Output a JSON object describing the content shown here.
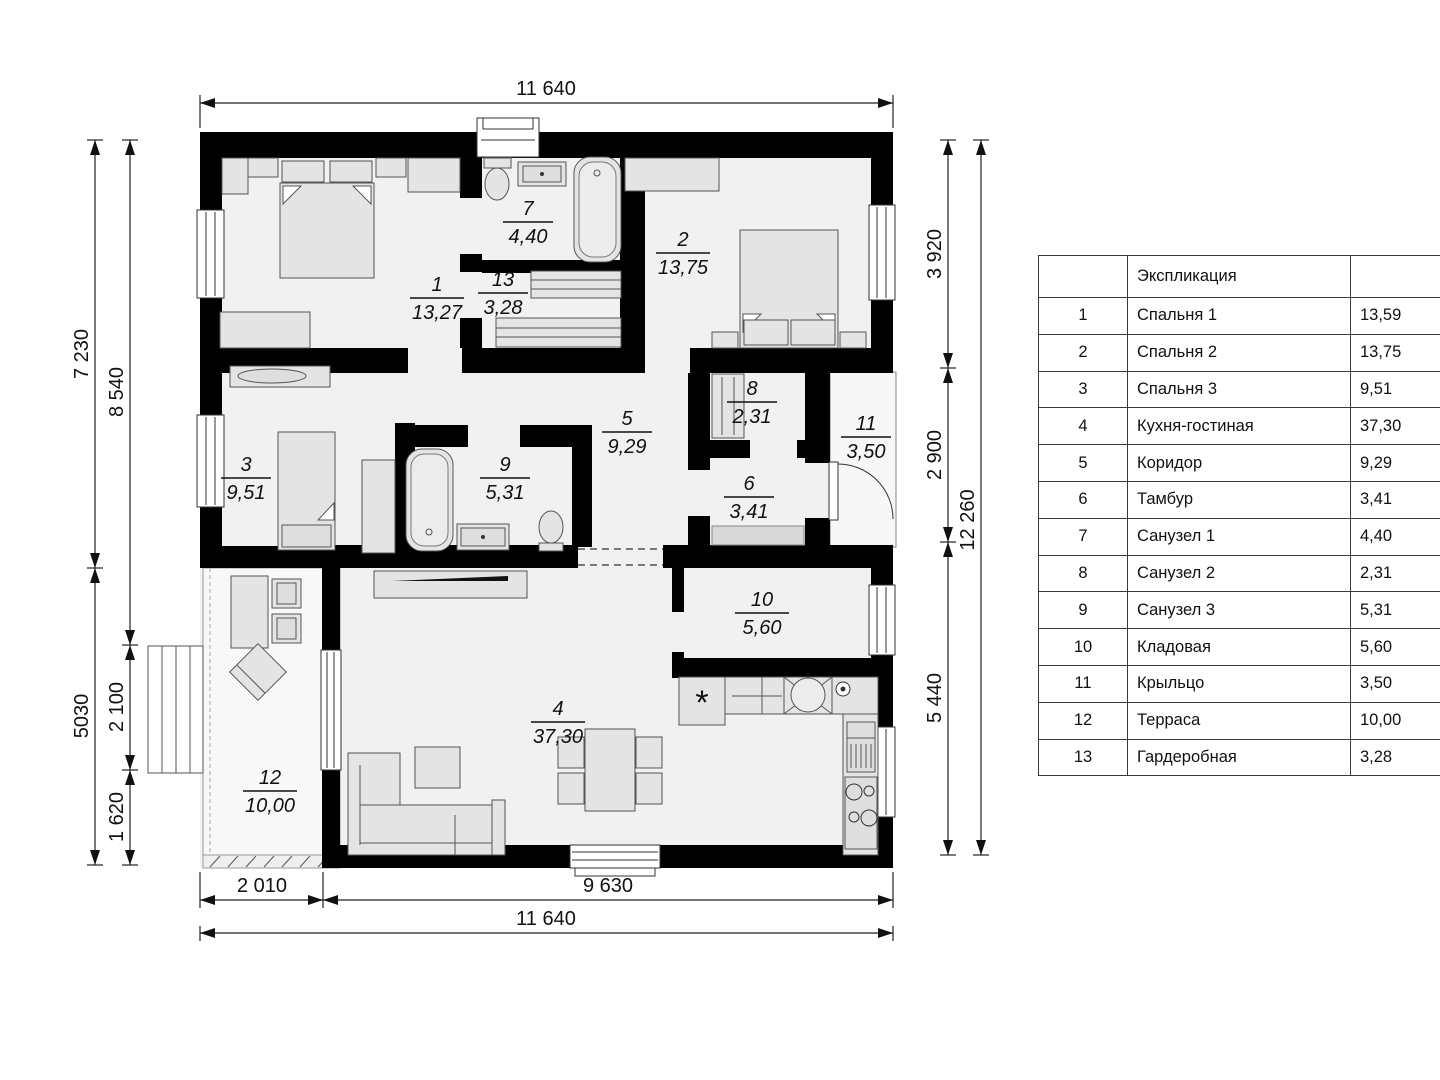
{
  "plan": {
    "rooms": [
      {
        "num": "1",
        "area": "13,27"
      },
      {
        "num": "2",
        "area": "13,75"
      },
      {
        "num": "3",
        "area": "9,51"
      },
      {
        "num": "4",
        "area": "37,30"
      },
      {
        "num": "5",
        "area": "9,29"
      },
      {
        "num": "6",
        "area": "3,41"
      },
      {
        "num": "7",
        "area": "4,40"
      },
      {
        "num": "8",
        "area": "2,31"
      },
      {
        "num": "9",
        "area": "5,31"
      },
      {
        "num": "10",
        "area": "5,60"
      },
      {
        "num": "11",
        "area": "3,50"
      },
      {
        "num": "12",
        "area": "10,00"
      },
      {
        "num": "13",
        "area": "3,28"
      }
    ],
    "dims": {
      "top": "11 640",
      "bottom_left": "2 010",
      "bottom_right": "9 630",
      "bottom_total": "11 640",
      "left_upper": "7 230",
      "left_lower": "5030",
      "left_inner_upper": "8 540",
      "left_inner_mid": "2 100",
      "left_inner_low": "1 620",
      "right_top": "3 920",
      "right_mid": "2 900",
      "right_low": "5 440",
      "right_total": "12 260"
    },
    "symbols": {
      "dishwasher": "*"
    }
  },
  "table": {
    "title": "Экспликация",
    "rows": [
      {
        "num": "1",
        "name": "Спальня 1",
        "area": "13,59"
      },
      {
        "num": "2",
        "name": "Спальня 2",
        "area": "13,75"
      },
      {
        "num": "3",
        "name": "Спальня 3",
        "area": "9,51"
      },
      {
        "num": "4",
        "name": "Кухня-гостиная",
        "area": "37,30"
      },
      {
        "num": "5",
        "name": "Коридор",
        "area": "9,29"
      },
      {
        "num": "6",
        "name": "Тамбур",
        "area": "3,41"
      },
      {
        "num": "7",
        "name": "Санузел 1",
        "area": "4,40"
      },
      {
        "num": "8",
        "name": "Санузел 2",
        "area": "2,31"
      },
      {
        "num": "9",
        "name": "Санузел 3",
        "area": "5,31"
      },
      {
        "num": "10",
        "name": "Кладовая",
        "area": "5,60"
      },
      {
        "num": "11",
        "name": "Крыльцо",
        "area": "3,50"
      },
      {
        "num": "12",
        "name": "Терраса",
        "area": "10,00"
      },
      {
        "num": "13",
        "name": "Гардеробная",
        "area": "3,28"
      }
    ]
  }
}
